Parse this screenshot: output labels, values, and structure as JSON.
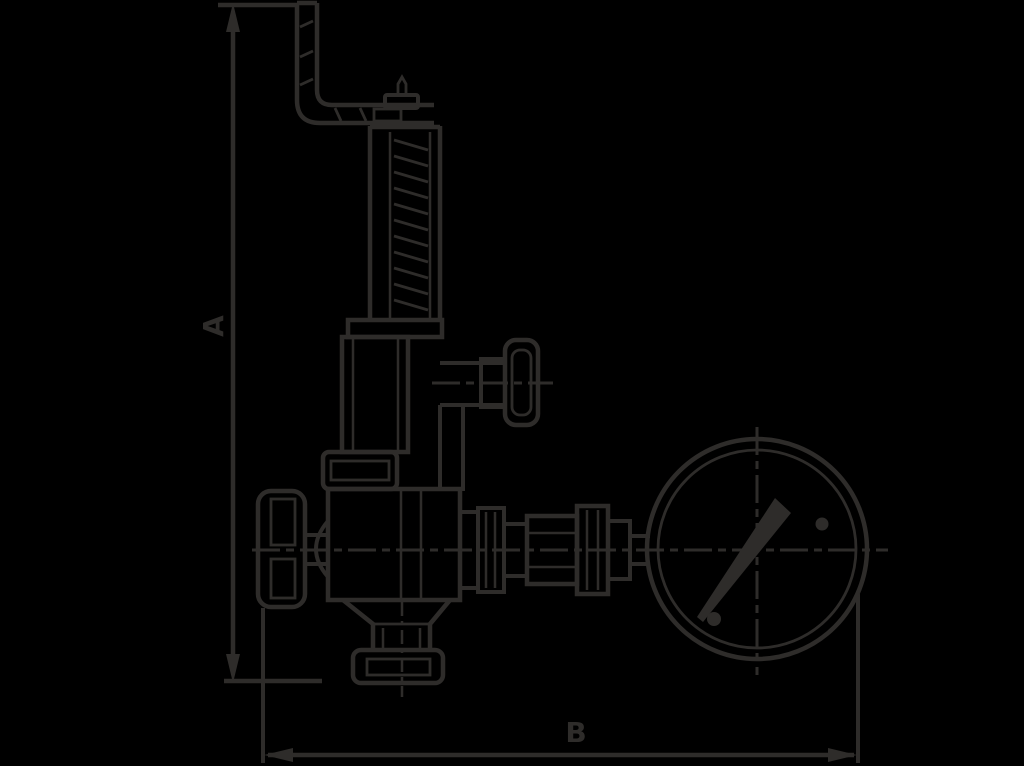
{
  "canvas": {
    "width": 1024,
    "height": 766,
    "background": "#000000",
    "line_color": "#2e2c2a"
  },
  "drawing": {
    "type": "technical-diagram",
    "subject": "angle safety valve with lever, spring bonnet, test handwheel and pressure gauge",
    "dimension_labels": {
      "vertical": "A",
      "horizontal": "B"
    }
  }
}
